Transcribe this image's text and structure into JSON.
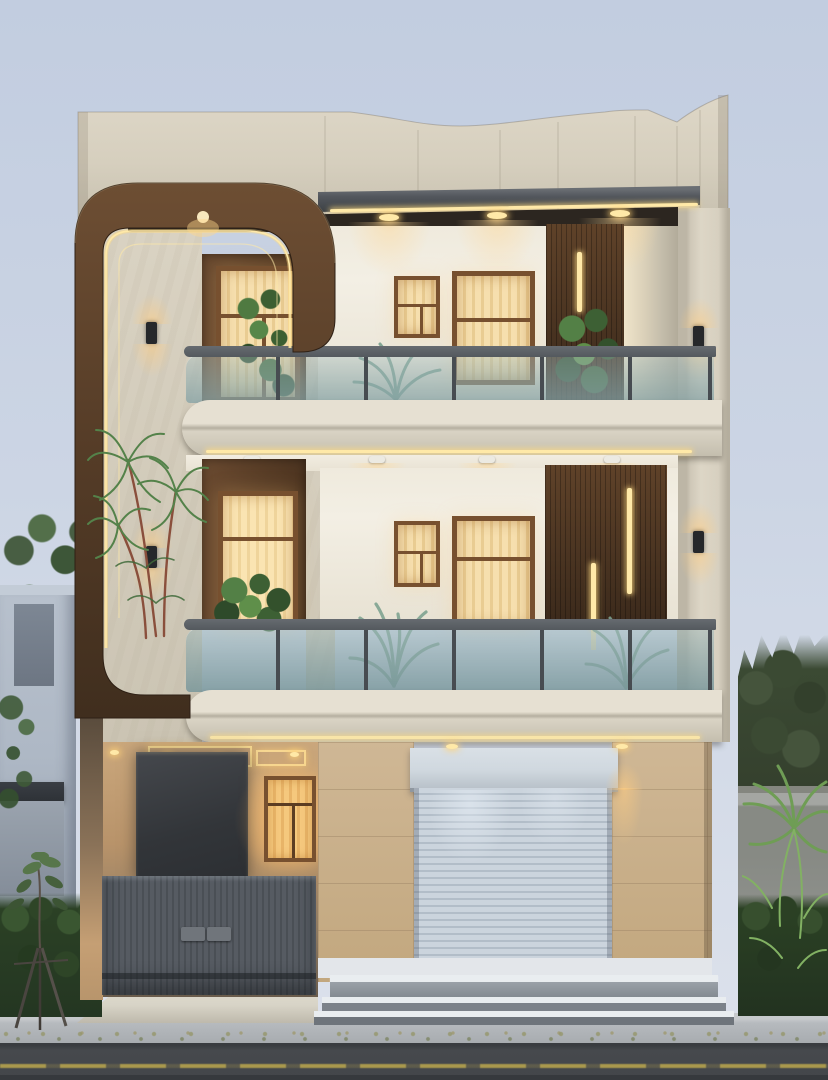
{
  "meta": {
    "title": "Modern three-storey house front elevation, dusk architectural render",
    "type": "architectural-3d-render",
    "time_of_day": "dusk",
    "floors_visible": 3
  },
  "colors": {
    "sky_top": "#c2cde0",
    "sky_mid": "#ccd5e4",
    "sky_low": "#dde2ec",
    "marble": "#dad3c3",
    "marble_dark": "#cbc4b3",
    "white_wall": "#f3efe4",
    "wood_light": "#5f4229",
    "wood_mid": "#6a4a30",
    "wood_dark": "#3a291b",
    "wood_dark2": "#4c3420",
    "gold": "#ffe9a8",
    "frame_brown": "#77502f",
    "curtain": "#f6dfae",
    "curtain_dk": "#e9cc92",
    "curtain_amber": "#f5c87d",
    "slab_grey": "#53575d",
    "soffit_dark": "#2c2620",
    "rail_grey": "#54595e",
    "post_grey": "#474c51",
    "glass_teal": "#8aa3a6",
    "fascia": "#e6e0d2",
    "fascia2": "#d9d3c4",
    "tan_tile": "#cfb795",
    "tan_tile2": "#c2a77e",
    "porch_warm": "#caa77c",
    "porch_deep": "#6a5c4c",
    "monolith": "#35383c",
    "gate_grey": "#565b62",
    "gate_slat": "#4a4f55",
    "gate_handle": "#70757b",
    "shutter": "#cbd4dd",
    "shutter_dk": "#b2bdc8",
    "shutter_header": "#d0d8df",
    "step_white": "#e9edf0",
    "step_riser": "#8e949b",
    "sidewalk": "#b6babe",
    "ramp": "#d8d4c7",
    "road": "#46494d",
    "road_line": "#c3ad4e",
    "green_dark": "#2e4a2a",
    "green_mid": "#446b38",
    "green_bright": "#5f8f4a",
    "green_glass": "#7fa391",
    "neighbor_wall": "#aeb8c5",
    "neighbor_canopy": "#2e3237",
    "compound_wall": "#8f918d",
    "coping": "#a4a6a2",
    "plinth": "#e3e6ea"
  },
  "scene": {
    "building": {
      "style": "modern duplex elevation",
      "features": [
        "curved-wood-feature-frame-with-led-pinstripes",
        "travertine-parapet-with-wavy-top",
        "dark-roof-slab-with-led-strip",
        "two-glass-railing-balconies",
        "vertical-wood-slat-panels-with-led-bars",
        "warm-lit-curtained-windows",
        "ground-floor-roller-shutter-garage",
        "recessed-entry-porch-with-cove-lighting",
        "grey-slatted-entry-gate",
        "wide-entry-steps"
      ],
      "lighting": [
        "recessed-downlights",
        "surface-puck-lights",
        "up-down-wall-sconces",
        "led-cove-strips"
      ]
    },
    "surroundings": [
      "neighbor-house-left",
      "tree-canopy-left",
      "sapling-with-stakes",
      "hedges",
      "compound-wall-right",
      "palm-right",
      "tree-mass-right",
      "sidewalk",
      "asphalt-road-with-yellow-line"
    ]
  }
}
